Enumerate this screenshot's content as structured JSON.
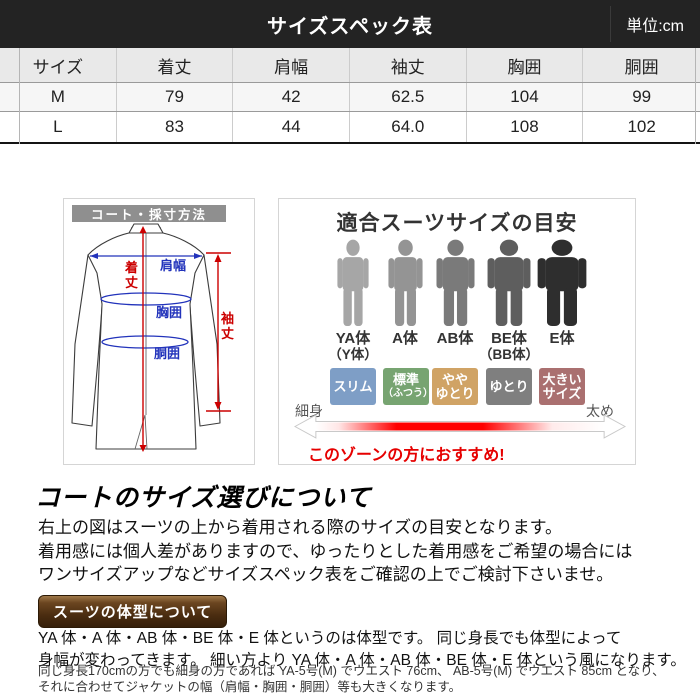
{
  "topbar": {
    "title": "サイズスペック表",
    "unit": "単位:cm"
  },
  "size_table": {
    "columns": [
      "サイズ",
      "着丈",
      "肩幅",
      "袖丈",
      "胸囲",
      "胴囲"
    ],
    "rows": [
      {
        "size": "M",
        "values": [
          "79",
          "42",
          "62.5",
          "104",
          "99"
        ]
      },
      {
        "size": "L",
        "values": [
          "83",
          "44",
          "64.0",
          "108",
          "102"
        ]
      }
    ]
  },
  "measure_diagram": {
    "title": "コート・採寸方法",
    "labels": {
      "length": "着丈",
      "shoulder": "肩幅",
      "sleeve": "袖丈",
      "chest": "胸囲",
      "waist": "胴囲"
    },
    "accent_red": "#cc0000",
    "accent_blue": "#2233bb"
  },
  "fit_chart": {
    "title": "適合スーツサイズの目安",
    "body_types": [
      {
        "name": "YA体",
        "alias": "（Y体）",
        "color": "#a6a6a6",
        "fit_lines": [
          "スリム"
        ],
        "fit_color": "#7e9ec6"
      },
      {
        "name": "A体",
        "alias": "",
        "color": "#949494",
        "fit_lines": [
          "標準",
          "（ふつう）"
        ],
        "fit_color": "#77a471"
      },
      {
        "name": "AB体",
        "alias": "",
        "color": "#7a7a7a",
        "fit_lines": [
          "やや",
          "ゆとり"
        ],
        "fit_color": "#d0a365"
      },
      {
        "name": "BE体",
        "alias": "（BB体）",
        "color": "#5e5e5e",
        "fit_lines": [
          "ゆとり"
        ],
        "fit_color": "#7f7f7f"
      },
      {
        "name": "E体",
        "alias": "",
        "color": "#2e2e2e",
        "fit_lines": [
          "大きい",
          "サイズ"
        ],
        "fit_color": "#aa7070"
      }
    ],
    "scale_left": "細身",
    "scale_right": "太め",
    "recommend": "このゾーンの方におすすめ!",
    "recommend_color": "#e60000"
  },
  "coat_section": {
    "heading": "コートのサイズ選びについて",
    "lines": [
      "右上の図はスーツの上から着用される際のサイズの目安となります。",
      "着用感には個人差がありますので、ゆったりとした着用感をご希望の場合には",
      "ワンサイズアップなどサイズスペック表をご確認の上でご検討下さいませ。"
    ]
  },
  "body_type_section": {
    "tag": "スーツの体型について",
    "lines": [
      "YA 体・A 体・AB 体・BE 体・E 体というのは体型です。 同じ身長でも体型によって",
      "身幅が変わってきます。 細い方より YA 体・A 体・AB 体・BE 体・E 体という風になります。"
    ],
    "note_lines": [
      "同じ身長170cmの方でも細身の方であれば YA-5号(M) でウエスト 76cm、 AB-5号(M) でウエスト 85cm となり、",
      "それに合わせてジャケットの幅（肩幅・胸囲・胴囲）等も大きくなります。"
    ]
  }
}
